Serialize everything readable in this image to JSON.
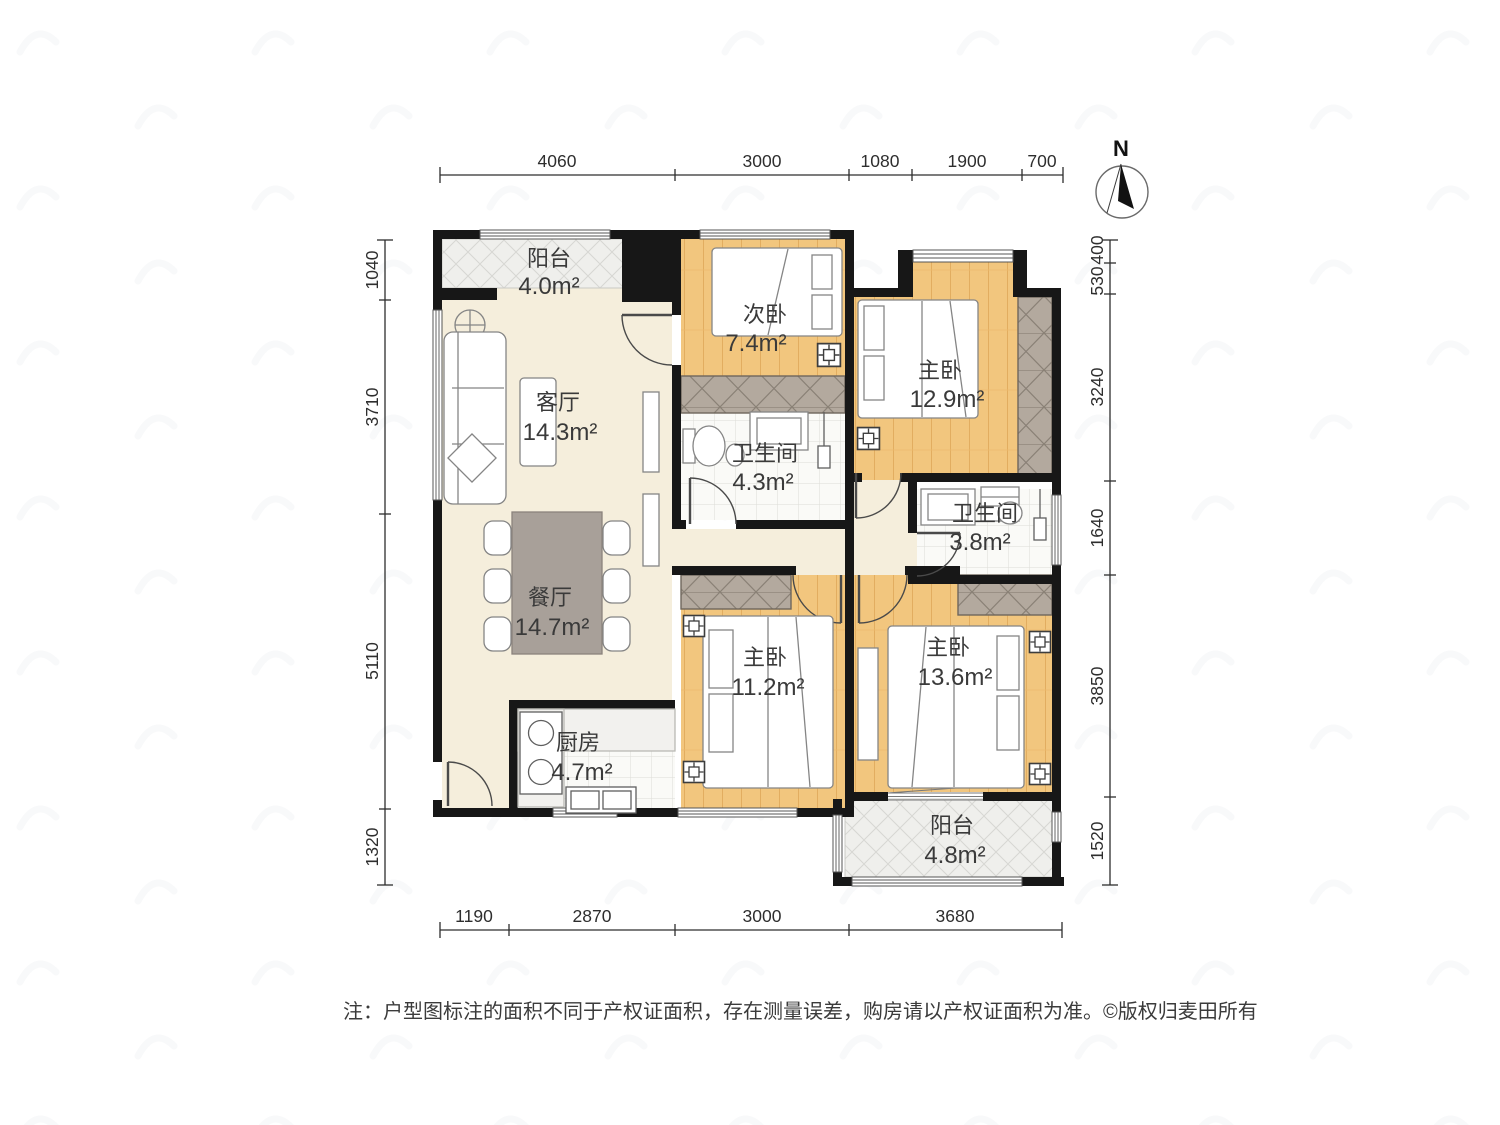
{
  "compass": {
    "label": "N"
  },
  "rooms": [
    {
      "id": "balcony-top",
      "name": "阳台",
      "area": "4.0m²"
    },
    {
      "id": "secondary-bedroom",
      "name": "次卧",
      "area": "7.4m²"
    },
    {
      "id": "master-bedroom-a",
      "name": "主卧",
      "area": "12.9m²"
    },
    {
      "id": "living-room",
      "name": "客厅",
      "area": "14.3m²"
    },
    {
      "id": "bathroom-a",
      "name": "卫生间",
      "area": "4.3m²"
    },
    {
      "id": "bathroom-b",
      "name": "卫生间",
      "area": "3.8m²"
    },
    {
      "id": "dining-room",
      "name": "餐厅",
      "area": "14.7m²"
    },
    {
      "id": "master-bedroom-b",
      "name": "主卧",
      "area": "11.2m²"
    },
    {
      "id": "master-bedroom-c",
      "name": "主卧",
      "area": "13.6m²"
    },
    {
      "id": "kitchen",
      "name": "厨房",
      "area": "4.7m²"
    },
    {
      "id": "balcony-bottom",
      "name": "阳台",
      "area": "4.8m²"
    }
  ],
  "dimensions": {
    "top": [
      "4060",
      "3000",
      "1080",
      "1900",
      "700"
    ],
    "bottom": [
      "1190",
      "2870",
      "3000",
      "3680"
    ],
    "left": [
      "1040",
      "3710",
      "5110",
      "1320"
    ],
    "right": [
      "400",
      "530",
      "3240",
      "1640",
      "3850",
      "1520"
    ]
  },
  "footer": {
    "note": "注：户型图标注的面积不同于产权证面积，存在测量误差，购房请以产权证面积为准。",
    "copyright": "©版权归麦田所有"
  },
  "colors": {
    "wall": "#171717",
    "wood_floor": "#f2c67e",
    "open_floor": "#f5eedc",
    "tile_floor": "#fafaf7",
    "wardrobe": "#b3a99e",
    "dining_table": "#a8a099"
  }
}
